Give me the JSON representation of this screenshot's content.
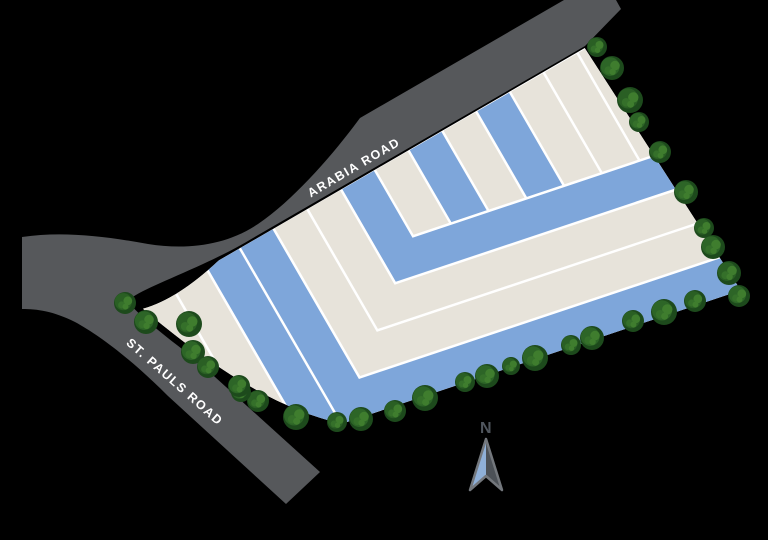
{
  "title": "Site plan map",
  "roads": {
    "arabia": {
      "label": "ARABIA ROAD"
    },
    "st_pauls": {
      "label": "ST. PAULS ROAD"
    }
  },
  "compass": {
    "label": "N"
  },
  "colors": {
    "background": "#000000",
    "road": "#56585B",
    "road_text": "#FFFFFF",
    "plot_blue": "#7EA6DA",
    "plot_beige": "#E7E3DA",
    "separator": "#FFFFFF",
    "tree_base": "#1D4A1C",
    "tree_mid_a": "#2D6527",
    "tree_mid_b": "#2A5F24",
    "tree_light": "#3F7D2E",
    "tree_light2": "#35702A",
    "compass_blue": "#8FB0D8",
    "compass_gray": "#4C5157",
    "compass_outline": "#73777C",
    "compass_text": "#50565E"
  },
  "plots": {
    "inner_boundary_offset": 156.5,
    "strips": [
      {
        "id": "A",
        "kind": "left",
        "x0": -118,
        "x1": -80,
        "color": "beige"
      },
      {
        "id": "B",
        "kind": "left",
        "x0": -77.5,
        "x1": -41,
        "color": "beige"
      },
      {
        "id": "C",
        "kind": "left",
        "x0": -38.5,
        "x1": -2,
        "color": "blue"
      },
      {
        "id": "L1",
        "kind": "band",
        "x0": 0.5,
        "x1": 37,
        "o0": 0,
        "o1": 37,
        "color": "blue"
      },
      {
        "id": "L2",
        "kind": "band",
        "x0": 39.5,
        "x1": 76,
        "o0": 39.5,
        "o1": 76,
        "color": "beige"
      },
      {
        "id": "L3",
        "kind": "band",
        "x0": 78.5,
        "x1": 115,
        "o0": 78.5,
        "o1": 115,
        "color": "beige"
      },
      {
        "id": "L4",
        "kind": "band",
        "x0": 117.5,
        "x1": 154,
        "o0": 117.5,
        "o1": 154,
        "color": "blue"
      },
      {
        "id": "S1",
        "kind": "inner",
        "x0": 156.5,
        "x1": 193,
        "color": "beige"
      },
      {
        "id": "S2",
        "kind": "inner",
        "x0": 195.5,
        "x1": 232,
        "color": "blue"
      },
      {
        "id": "S3",
        "kind": "inner",
        "x0": 234.5,
        "x1": 271,
        "color": "beige"
      },
      {
        "id": "S4",
        "kind": "inner",
        "x0": 273.5,
        "x1": 310,
        "color": "blue"
      },
      {
        "id": "S5",
        "kind": "inner",
        "x0": 312.5,
        "x1": 349,
        "color": "beige"
      },
      {
        "id": "S6",
        "kind": "inner",
        "x0": 351.5,
        "x1": 388,
        "color": "beige"
      },
      {
        "id": "S7",
        "kind": "inner",
        "x0": 390.5,
        "x1": 427,
        "color": "beige"
      }
    ]
  },
  "trees": [
    [
      597,
      47,
      10
    ],
    [
      612,
      68,
      12
    ],
    [
      630,
      100,
      13
    ],
    [
      639,
      122,
      10
    ],
    [
      660,
      152,
      11
    ],
    [
      686,
      192,
      12
    ],
    [
      704,
      228,
      10
    ],
    [
      713,
      247,
      12
    ],
    [
      729,
      273,
      12
    ],
    [
      739,
      296,
      11
    ],
    [
      695,
      301,
      11
    ],
    [
      664,
      312,
      13
    ],
    [
      633,
      321,
      11
    ],
    [
      592,
      338,
      12
    ],
    [
      571,
      345,
      10
    ],
    [
      535,
      358,
      13
    ],
    [
      511,
      366,
      9
    ],
    [
      487,
      376,
      12
    ],
    [
      465,
      382,
      10
    ],
    [
      425,
      398,
      13
    ],
    [
      395,
      411,
      11
    ],
    [
      361,
      419,
      12
    ],
    [
      337,
      422,
      10
    ],
    [
      296,
      417,
      13
    ],
    [
      258,
      401,
      11
    ],
    [
      241,
      392,
      10
    ],
    [
      125,
      303,
      11
    ],
    [
      146,
      322,
      12
    ],
    [
      189,
      324,
      13
    ],
    [
      193,
      352,
      12
    ],
    [
      208,
      367,
      11
    ],
    [
      239,
      386,
      11
    ]
  ]
}
